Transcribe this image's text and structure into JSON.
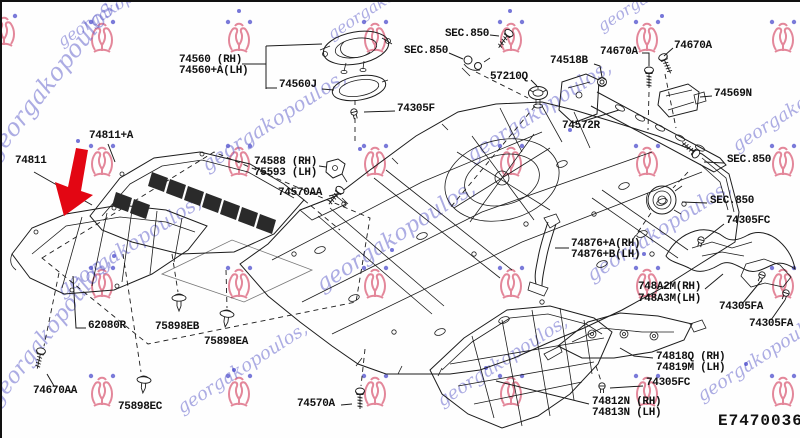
{
  "diagram": {
    "code": "E7470036",
    "arrow_color": "#e30613",
    "line_color": "#1c1c1c"
  },
  "watermark": {
    "text": "georgakopoulos,",
    "text_color": "#5d5dc9",
    "crest_color": "#dd6a82",
    "dot_color": "#3c3cc8"
  },
  "labels": {
    "l74560rh": "74560 (RH)",
    "l74560lh": "74560+A(LH)",
    "l74560j": "74560J",
    "sec850": "SEC.850",
    "l57210q": "57210Q",
    "l74518b": "74518B",
    "l74670a": "74670A",
    "l74569n": "74569N",
    "l74305f": "74305F",
    "l74572r": "74572R",
    "l74811a": "74811+A",
    "l74811": "74811",
    "l74588rh": "74588 (RH)",
    "l75593lh": "75593 (LH)",
    "l74570aa": "74570AA",
    "l74305fc": "74305FC",
    "l74876a": "74876+A(RH)",
    "l74876b": "74876+B(LH)",
    "l748a2m": "748A2M(RH)",
    "l748a3m": "748A3M(LH)",
    "l74305fa": "74305FA",
    "l74818q": "74818Q (RH)",
    "l74819m": "74819M (LH)",
    "l74812n": "74812N (RH)",
    "l74813n": "74813N (LH)",
    "l62080r": "62080R",
    "l75898eb": "75898EB",
    "l75898ea": "75898EA",
    "l75898ec": "75898EC",
    "l74670aa": "74670AA",
    "l74570a": "74570A"
  }
}
